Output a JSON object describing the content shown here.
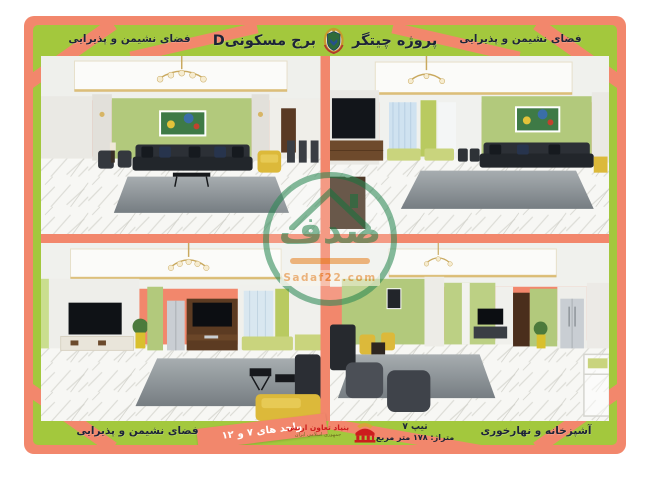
{
  "header": {
    "project_title": "پروژه چیتگر",
    "tower_title": "برج مسکونیD"
  },
  "panels": {
    "top_left_label": "فضای نشیمن و پذیرایی",
    "top_right_label": "فضای نشیمن و پذیرایی",
    "bottom_left_label": "فضای نشیمن و پذیرایی",
    "bottom_right_label": "آشپزخانه و نهارخوری"
  },
  "footer": {
    "units_ribbon": "واحد های ۷ و ۱۲",
    "type": "تیپ ۷",
    "area": "متراژ: ۱۷۸ متر مربع",
    "foundation_name": "بنیاد تعاون ارتش",
    "foundation_subtitle": "جمهوری اسلامی ایران"
  },
  "watermark": {
    "brand": "صدف",
    "site": "Sadaf22.com"
  },
  "icons": {
    "header_emblem": "army-emblem-icon",
    "foundation_emblem": "foundation-emblem-icon",
    "watermark_house": "house-icon"
  },
  "colors": {
    "frame_salmon": "#f2876c",
    "band_green": "#a3c83d",
    "text_navy": "#1d2438",
    "accent_red": "#cc1d1d",
    "watermark_green": "#2e8a57",
    "watermark_orange": "#e8862a"
  }
}
